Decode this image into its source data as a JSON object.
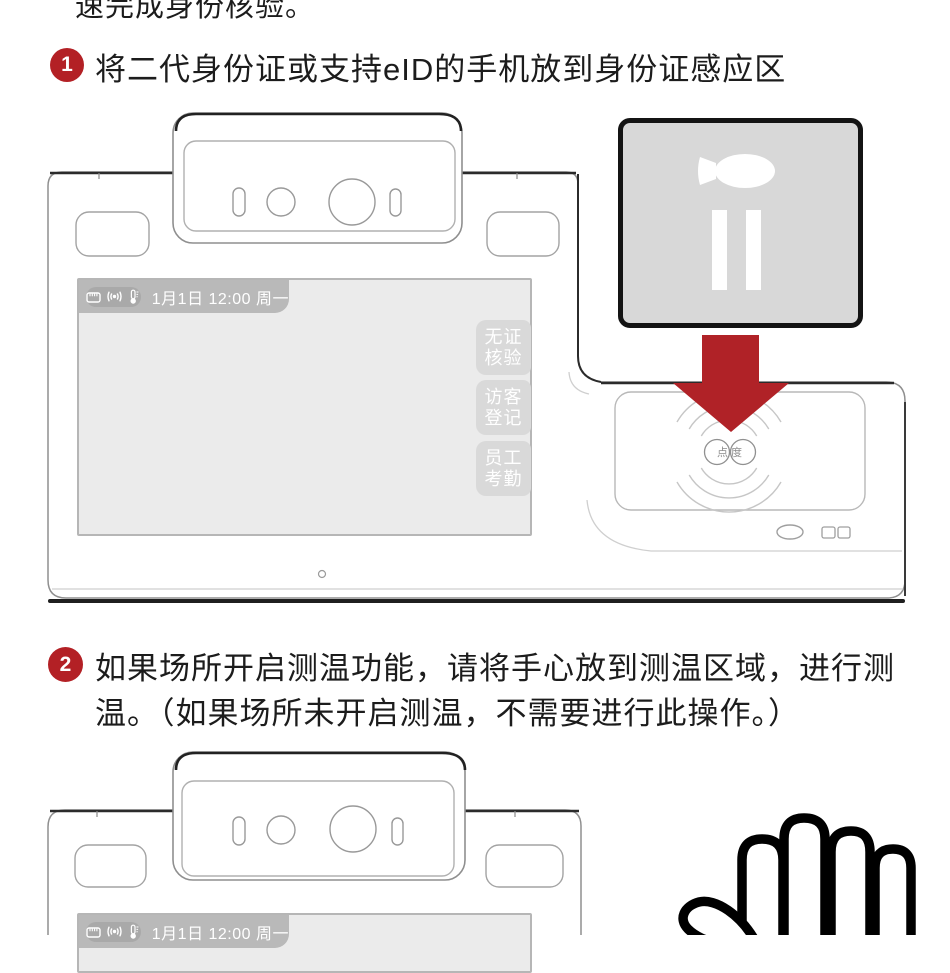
{
  "intro": {
    "clipped_line": "速完成身份核验。"
  },
  "steps": [
    {
      "num": "1",
      "lines": [
        "将二代身份证或支持eID的手机放到身份证感应区"
      ]
    },
    {
      "num": "2",
      "lines": [
        "如果场所开启测温功能，请将手心放到测温区域，进行测",
        "温。（如果场所未开启测温，不需要进行此操作。）"
      ]
    }
  ],
  "device_screen": {
    "statusbar": {
      "date": "1月1日 12:00 周一",
      "icons": [
        "lan-port-icon",
        "wireless-signal-icon",
        "thermometer-icon"
      ]
    },
    "side_buttons": [
      {
        "line1": "无证",
        "line2": "核验"
      },
      {
        "line1": "访客",
        "line2": "登记"
      },
      {
        "line1": "员工",
        "line2": "考勤"
      }
    ]
  },
  "sensor_pad": {
    "logo": "点度"
  },
  "colors": {
    "accent_red": "#b02227",
    "badge_red": "#b32025",
    "card_gray": "#d8d8d8",
    "screen_gray": "#ebebeb",
    "statusbar_gray": "#b9b9b9",
    "button_gray": "#d9d9d9",
    "text": "#1c1c1c"
  }
}
